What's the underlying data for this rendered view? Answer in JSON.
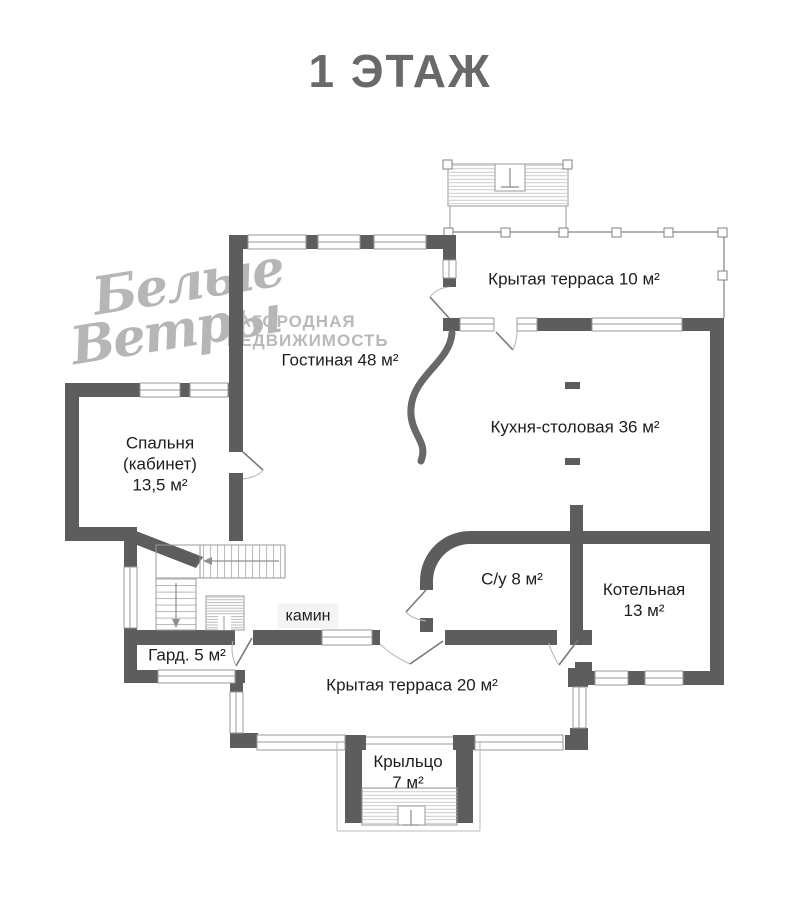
{
  "title": "1 ЭТАЖ",
  "watermark": {
    "script_line1": "Белые",
    "script_line2": "Ветры",
    "caption_line1": "ЗАГОРОДНАЯ",
    "caption_line2": "НЕДВИЖИМОСТЬ"
  },
  "rooms": {
    "terrace_top": {
      "label": "Крытая терраса 10 м²"
    },
    "living": {
      "label": "Гостиная 48 м²"
    },
    "kitchen": {
      "label": "Кухня-столовая 36 м²"
    },
    "bedroom": {
      "label": "Спальня\n(кабинет)\n13,5 м²"
    },
    "bathroom": {
      "label": "С/у 8 м²"
    },
    "boiler": {
      "label": "Котельная\n13 м²"
    },
    "wardrobe": {
      "label": "Гард. 5 м²"
    },
    "fireplace": {
      "label": "камин"
    },
    "terrace_bottom": {
      "label": "Крытая терраса 20 м²"
    },
    "porch": {
      "label": "Крыльцо\n7 м²"
    }
  },
  "icons": {
    "entrance_top": "entry-marker",
    "entrance_porch": "entry-marker",
    "stair_arrow_horizontal": "arrow-left",
    "stair_arrow_vertical": "arrow-down"
  },
  "colors": {
    "wall": "#5d5d5d",
    "thin_line": "#9a9a9a",
    "hatch": "#c4c4c4",
    "label_text": "#1d1d1d",
    "title_text": "#696969",
    "watermark": "#b6b6b6",
    "fireplace_label_bg": "#f4f4f4"
  }
}
